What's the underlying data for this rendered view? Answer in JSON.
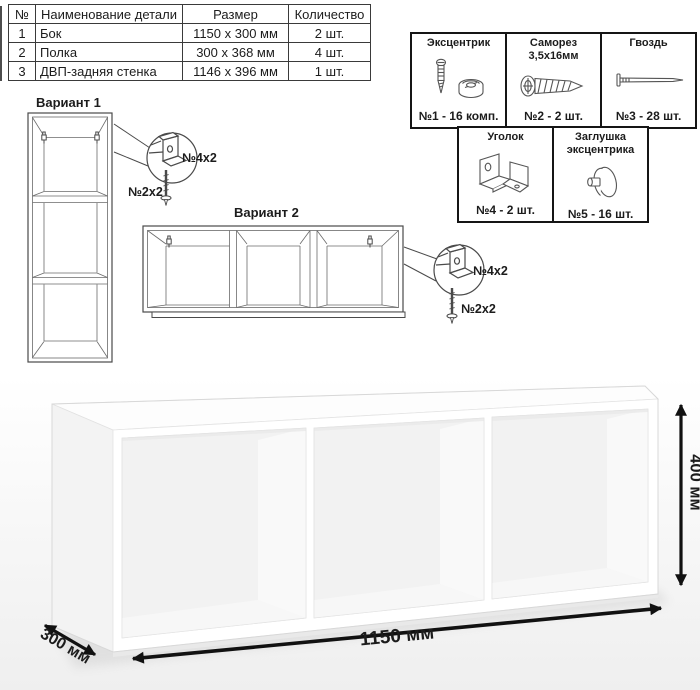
{
  "parts_table": {
    "headers": [
      "№",
      "Наименование детали",
      "Размер",
      "Количество"
    ],
    "rows": [
      {
        "num": "1",
        "name": "Бок",
        "size": "1150 x 300 мм",
        "qty": "2 шт."
      },
      {
        "num": "2",
        "name": "Полка",
        "size": "300 x 368 мм",
        "qty": "4 шт."
      },
      {
        "num": "3",
        "name": "ДВП-задняя стенка",
        "size": "1146 x 396 мм",
        "qty": "1 шт."
      }
    ]
  },
  "hardware": {
    "items": [
      {
        "title": "Эксцентрик",
        "label": "№1 - 16 комп.",
        "icon": "cam-bolt-and-lock-icon"
      },
      {
        "title": "Саморез 3,5х16мм",
        "label": "№2 - 2 шт.",
        "icon": "screw-icon"
      },
      {
        "title": "Гвоздь",
        "label": "№3 - 28 шт.",
        "icon": "nail-icon"
      },
      {
        "title": "Уголок",
        "label": "№4 - 2 шт.",
        "icon": "corner-bracket-icon"
      },
      {
        "title": "Заглушка эксцентрика",
        "label": "№5 - 16 шт.",
        "icon": "cam-cap-icon"
      }
    ]
  },
  "variant1": {
    "title": "Вариант 1",
    "bracket_label": "№4х2",
    "screw_label": "№2х2"
  },
  "variant2": {
    "title": "Вариант 2",
    "bracket_label": "№4х2",
    "screw_label": "№2х2"
  },
  "dimensions": {
    "width": "1150 мм",
    "depth": "300 мм",
    "height": "400 мм"
  },
  "colors": {
    "line": "#4a4a4a",
    "dimension_arrow": "#111111",
    "render_background": "#f2f2f2"
  }
}
